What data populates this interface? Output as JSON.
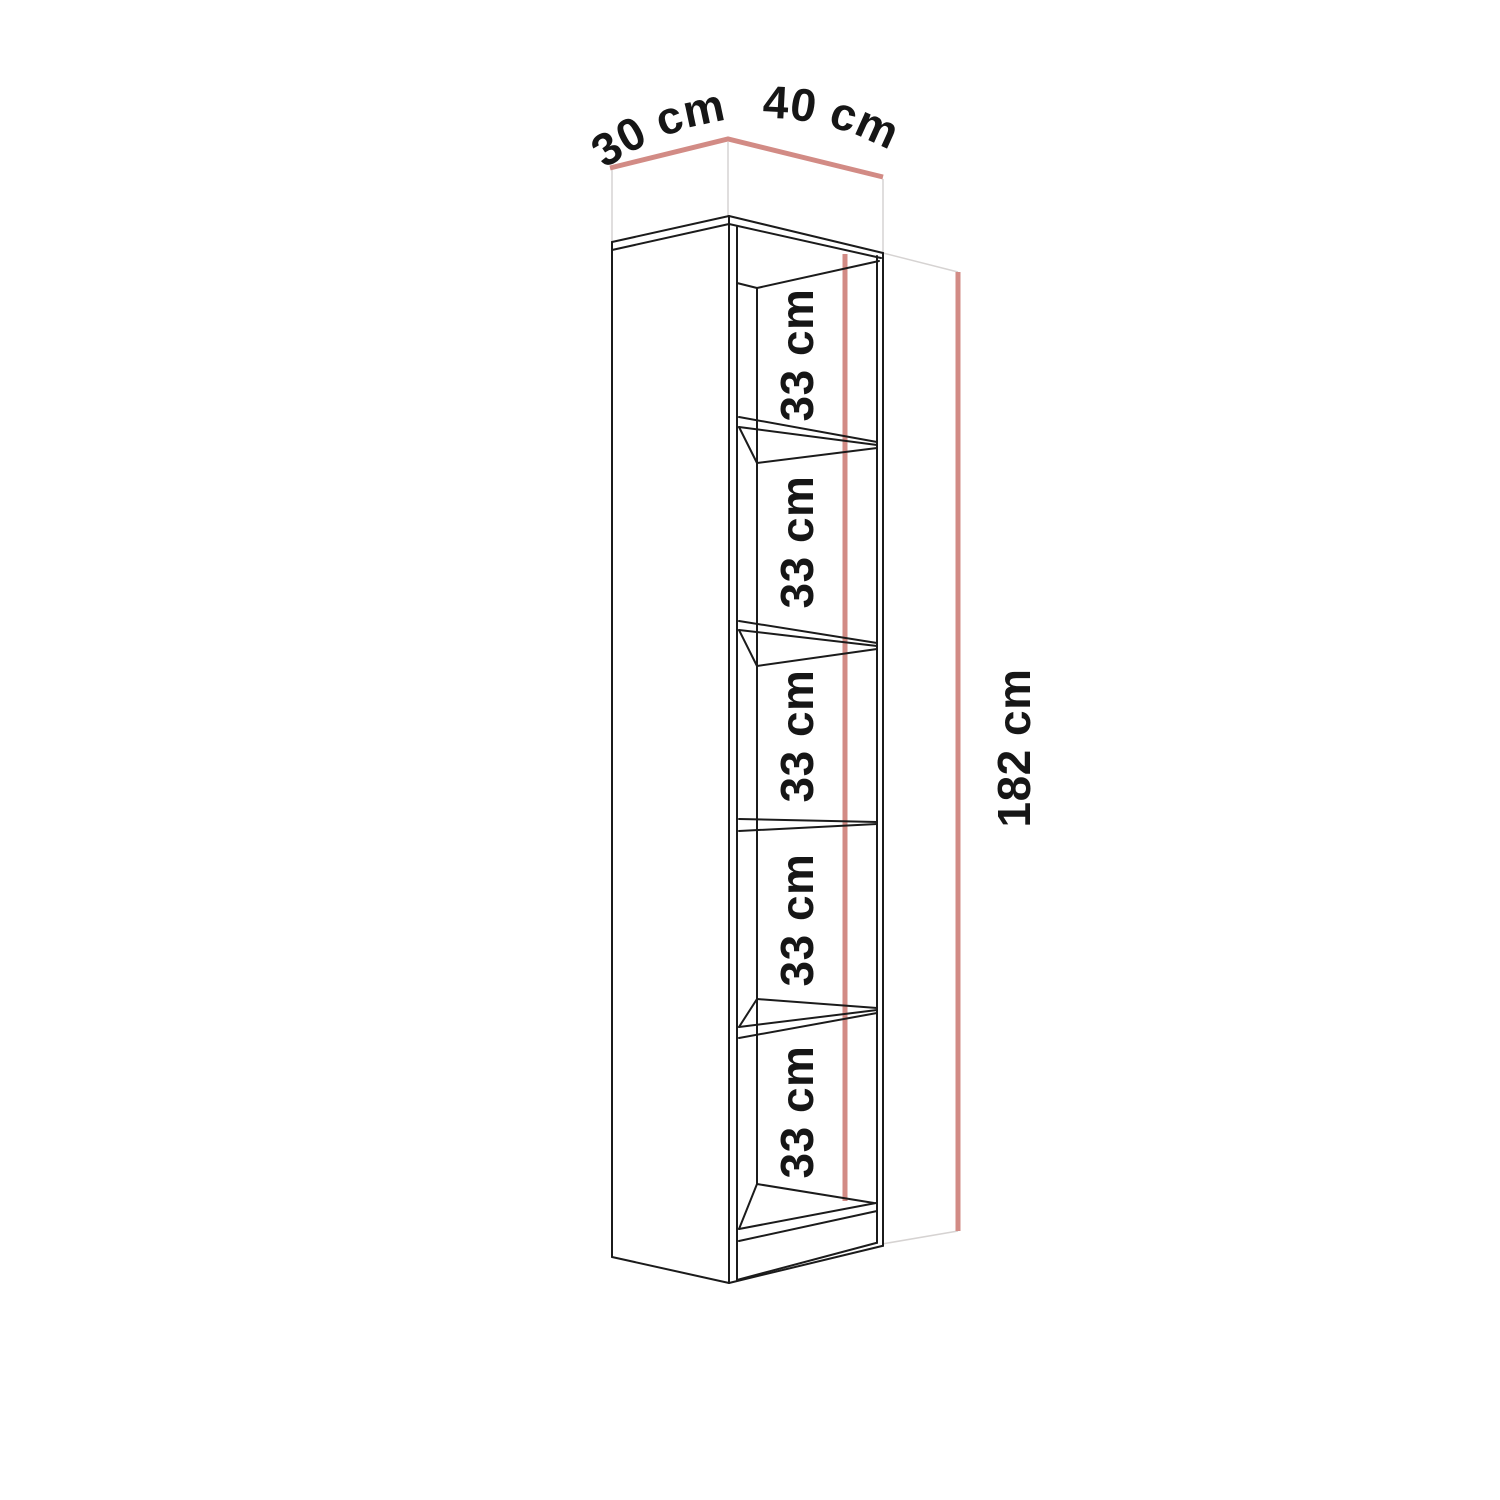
{
  "diagram": {
    "kind": "bookcase-dimension-drawing",
    "dimensions": {
      "depth": "30 cm",
      "width": "40 cm",
      "height": "182 cm"
    },
    "shelf_gaps": [
      "33 cm",
      "33 cm",
      "33 cm",
      "33 cm",
      "33 cm"
    ],
    "compartment_count": 5,
    "colors": {
      "line": "#1b1b1b",
      "dimension_line": "#d28b85",
      "guide_line": "#d6d3d2",
      "text": "#161616",
      "background": "#ffffff"
    }
  }
}
